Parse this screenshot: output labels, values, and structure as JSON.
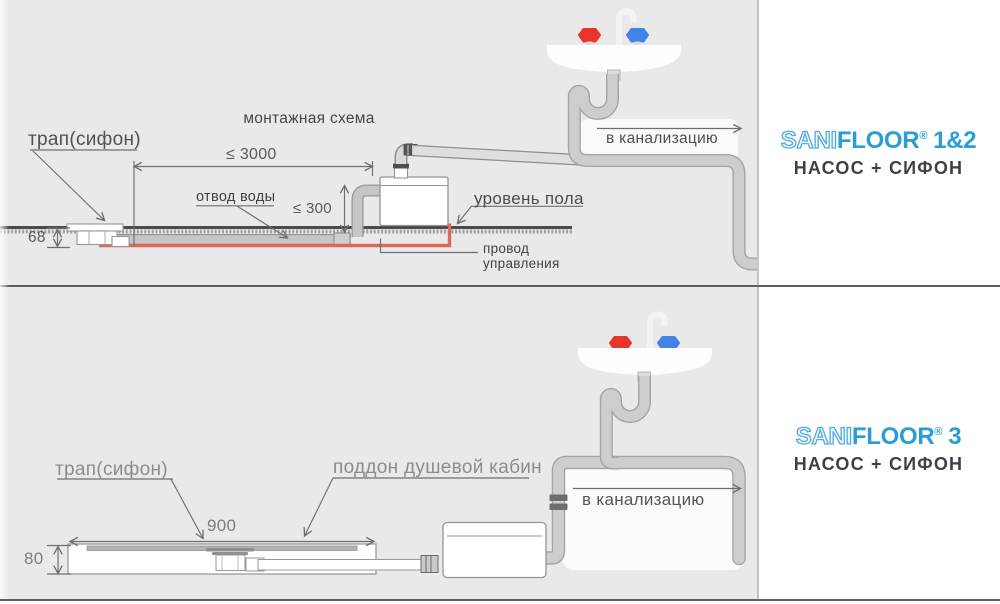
{
  "panels": {
    "top": {
      "title": "монтажная схема",
      "trap_label": "трап(сифон)",
      "dim_length": "≤ 3000",
      "water_outlet_label": "отвод воды",
      "dim_height": "≤ 300",
      "floor_level_label": "уровень пола",
      "control_wire_line1": "провод",
      "control_wire_line2": "управления",
      "dim_depth": "68",
      "sewer_label": "в канализацию",
      "logo": {
        "sani": "SANI",
        "floor": "FLOOR",
        "reg": "®",
        "model": "1&2",
        "subtitle": "НАСОС + СИФОН"
      }
    },
    "bottom": {
      "trap_label": "трап(сифон)",
      "tray_label": "поддон душевой кабин",
      "dim_width": "900",
      "dim_height": "80",
      "sewer_label": "в канализацию",
      "logo": {
        "sani": "SANI",
        "floor": "FLOOR",
        "reg": "®",
        "model": "3",
        "subtitle": "НАСОС + СИФОН"
      }
    },
    "colors": {
      "accent_blue": "#2a9cd8",
      "hot_tap_red": "#e8352c",
      "cold_tap_blue": "#4283e6",
      "control_wire_red": "#d96a57"
    }
  }
}
